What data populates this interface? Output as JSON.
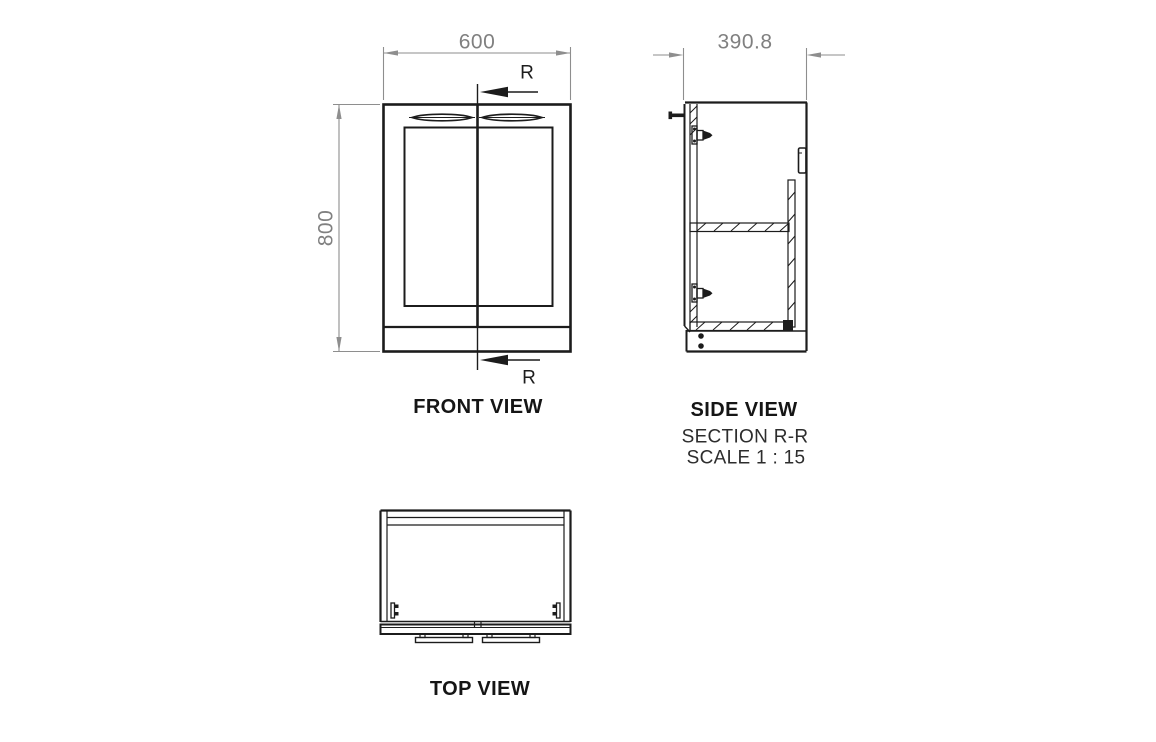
{
  "views": {
    "front": {
      "label": "FRONT VIEW",
      "width_dim": "600",
      "height_dim": "800",
      "section_letter": "R"
    },
    "side": {
      "label": "SIDE VIEW",
      "section_title": "SECTION R-R",
      "scale_note": "SCALE 1 : 15",
      "depth_dim": "390.8"
    },
    "top": {
      "label": "TOP VIEW"
    }
  },
  "colors": {
    "line": "#1c1c1c",
    "dimension": "#8e8e8e",
    "label_text": "#151515"
  }
}
